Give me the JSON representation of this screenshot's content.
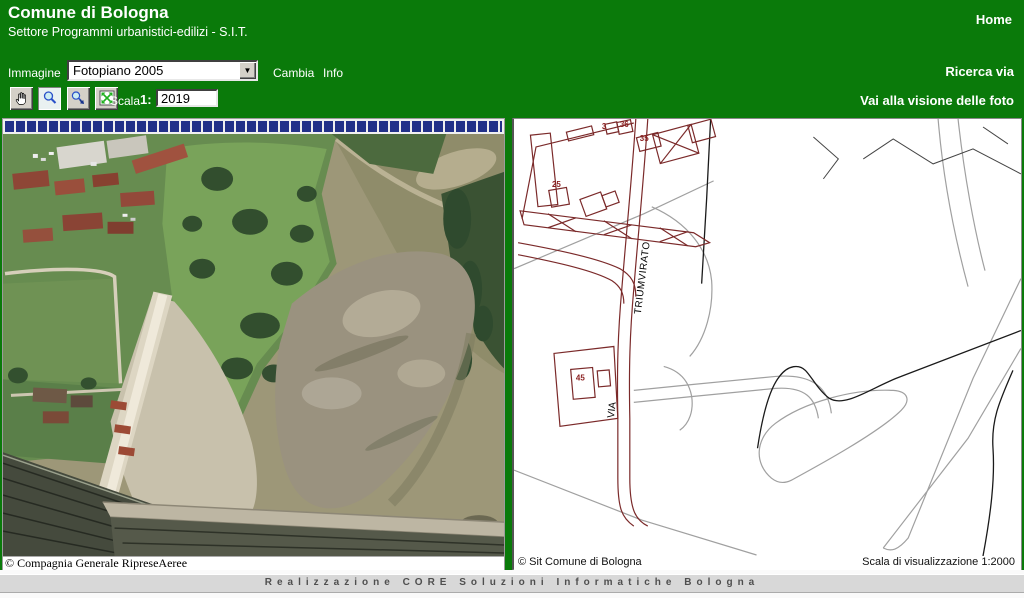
{
  "header": {
    "title": "Comune di Bologna",
    "subtitle": "Settore Programmi urbanistici-edilizi - S.I.T.",
    "home": "Home"
  },
  "toolbar": {
    "immagine_label": "Immagine",
    "layer_value": "Fotopiano 2005",
    "cambia": "Cambia",
    "info": "Info",
    "ricerca_via": "Ricerca via",
    "scala_label": "Scala",
    "scala_ratio": "1:",
    "scala_value": "2019",
    "vai_foto": "Vai alla visione delle foto",
    "tools": [
      "pan",
      "zoom",
      "zoom-area",
      "full-extent"
    ]
  },
  "left_panel": {
    "attribution": "© Compagnia Generale RipreseAeree"
  },
  "right_panel": {
    "attribution": "© Sit Comune di Bologna",
    "scale_text": "Scala di visualizzazione 1:2000",
    "street_name": "TRIUMVIRATO",
    "street_prefix": "VIA",
    "numbers": [
      "25",
      "3",
      "36",
      "35",
      "45"
    ]
  },
  "footer": {
    "credit": "Realizzazione CORE Soluzioni Informatiche Bologna"
  },
  "colors": {
    "header_green": "#0a7a0a",
    "progress_blue": "#223189",
    "map_line_red": "#7b2a2a"
  }
}
